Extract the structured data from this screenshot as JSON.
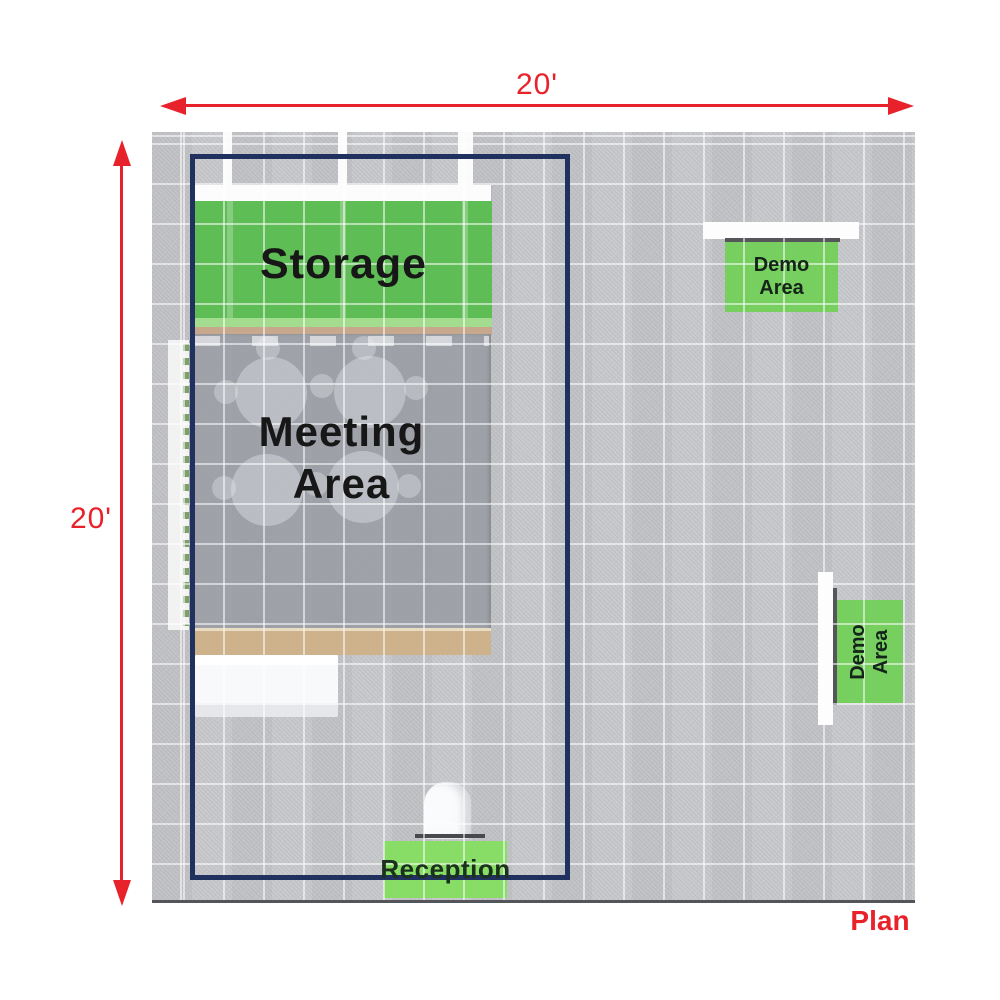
{
  "title": "Plan",
  "dimensions": {
    "horizontal": "20'",
    "vertical": "20'"
  },
  "areas": {
    "storage": {
      "label": "Storage"
    },
    "meeting": {
      "line1": "Meeting",
      "line2": "Area"
    },
    "reception": {
      "label": "Reception"
    },
    "demo_top": {
      "line1": "Demo",
      "line2": "Area"
    },
    "demo_right": {
      "line1": "Demo",
      "line2": "Area"
    }
  },
  "colors": {
    "dimension_red": "#e8222a",
    "booth_outline_navy": "#20305f",
    "storage_green": "#5ebd55",
    "demo_green": "#77cf60",
    "reception_green": "#87dd66",
    "carpet_gray": "#c6c7ca",
    "meeting_gray": "#969aa0",
    "wood_tan": "#cdb28c",
    "label_black": "#171717",
    "plan_red": "#e8222a"
  }
}
